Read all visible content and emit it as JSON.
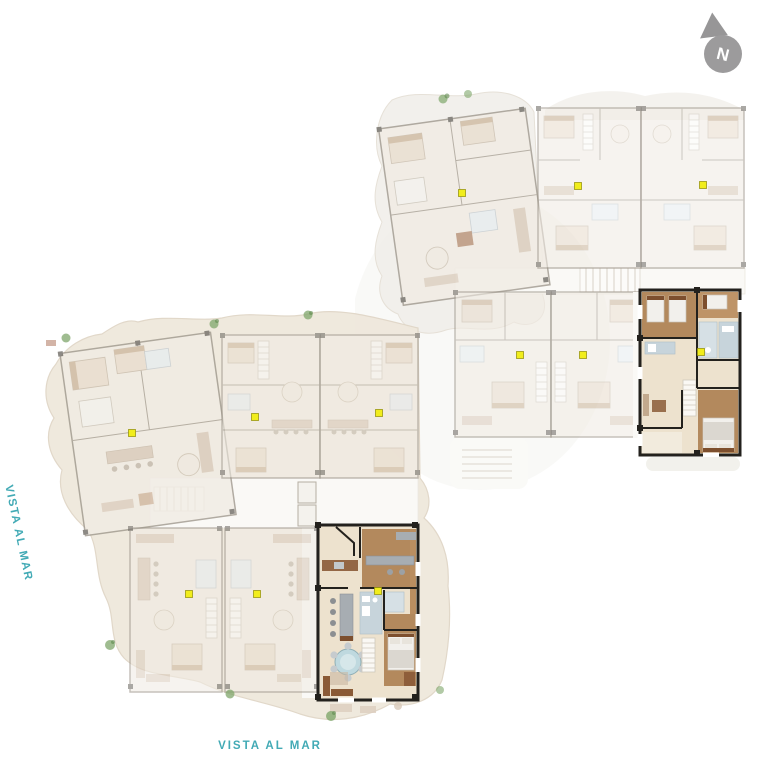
{
  "page": {
    "background": "#FFFFFF",
    "width": 768,
    "height": 768
  },
  "labels": {
    "left": {
      "text": "VISTA AL MAR",
      "color": "#42AAB5",
      "orientation": "rotated-vertical"
    },
    "bottom": {
      "text": "VISTA AL MAR",
      "color": "#42AAB5",
      "orientation": "horizontal"
    }
  },
  "compass": {
    "letter": "N",
    "circle_color": "#9C9B9C",
    "arrow_color": "#979697",
    "letter_color": "#FFFFFF"
  },
  "plans": [
    {
      "id": "upper-plan",
      "position": "top-right",
      "unit_count": 6,
      "highlighted_unit_position": "bottom-right",
      "marker_color": "#F1ED1C",
      "unit_markers": [
        {
          "x": 462,
          "y": 193
        },
        {
          "x": 578,
          "y": 186
        },
        {
          "x": 703,
          "y": 185
        },
        {
          "x": 520,
          "y": 355
        },
        {
          "x": 583,
          "y": 355
        },
        {
          "x": 701,
          "y": 352
        }
      ]
    },
    {
      "id": "lower-plan",
      "position": "bottom-left",
      "unit_count": 6,
      "highlighted_unit_position": "bottom-right",
      "marker_color": "#F1ED1C",
      "unit_markers": [
        {
          "x": 132,
          "y": 433
        },
        {
          "x": 255,
          "y": 417
        },
        {
          "x": 379,
          "y": 413
        },
        {
          "x": 189,
          "y": 594
        },
        {
          "x": 257,
          "y": 594
        },
        {
          "x": 378,
          "y": 591
        }
      ]
    }
  ],
  "palette": {
    "terrace_beige": "#EFE8DC",
    "terrace_edge": "#E0D6C7",
    "terrace_pale": "#F1EFEA",
    "faded_floor": "#F1ECE4",
    "faded_wall": "#9D968B",
    "faded_furniture": "#E9DDCE",
    "faded_wood": "#D9CABA",
    "faded_accent": "#6E6A64",
    "corridor_white": "#FAF9F6",
    "highlight_floor": "#EDE2CE",
    "highlight_wall": "#23211D",
    "wood_brown": "#B3895D",
    "dark_brown": "#7D4F2E",
    "sofa_brown": "#8A5A36",
    "wet_blue": "#C7D4DB",
    "counter_gray": "#A7ADB2",
    "bed_white": "#F2F0EC",
    "plant_green": "#7FA66B",
    "marker_yellow": "#F1ED1C"
  }
}
